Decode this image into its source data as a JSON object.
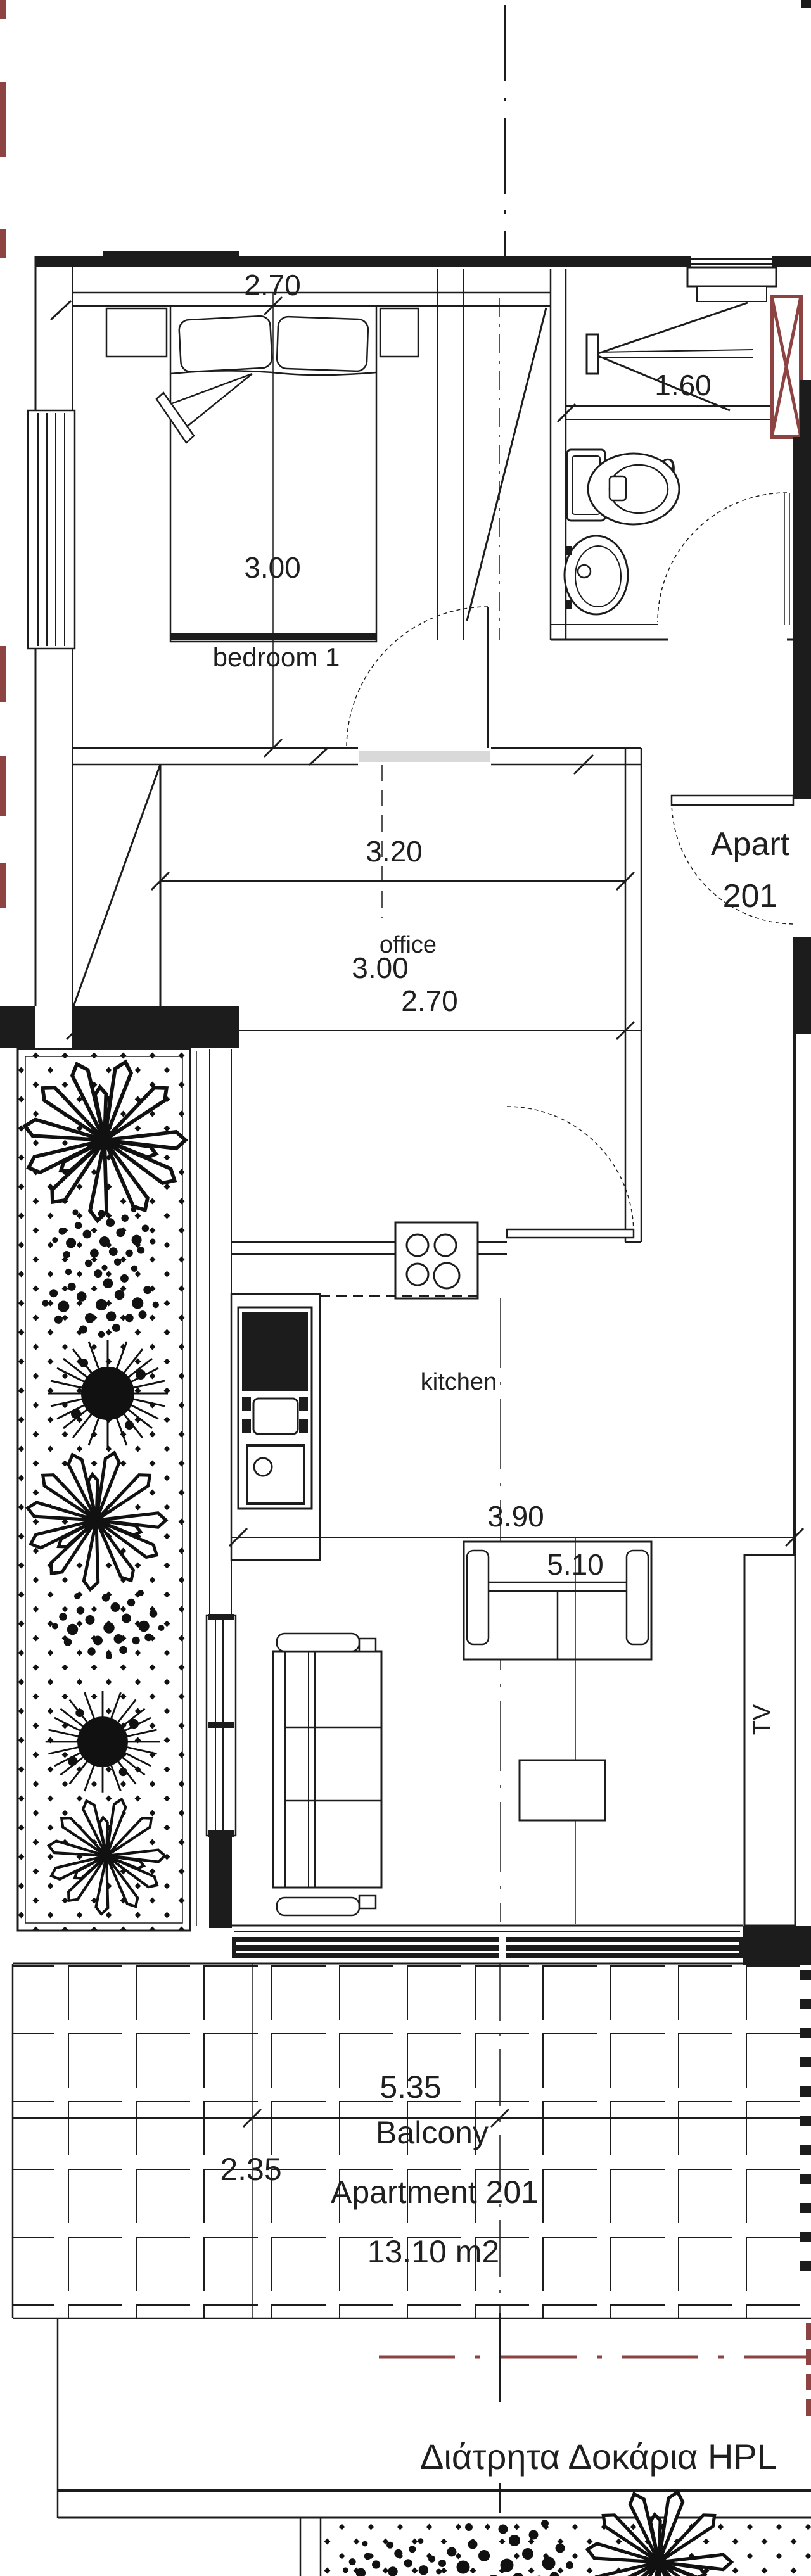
{
  "drawing": {
    "type": "floor-plan",
    "labels": {
      "bedroom": "bedroom 1",
      "office": "office",
      "kitchen": "kitchen",
      "tv": "TV",
      "apart_line1": "Apart",
      "apart_line2": "201",
      "balcony": "Balcony",
      "balcony_apartment": "Apartment 201",
      "balcony_area": "13.10 m2",
      "note_greek": "Διάτρητα Δοκάρια HPL"
    },
    "dimensions": {
      "bedroom_width": "2.70",
      "bedroom_length": "3.00",
      "shower_width": "1.60",
      "bathroom_width": "2.00",
      "office_width": "3.20",
      "office_depth_a": "3.00",
      "office_depth_b": "2.70",
      "kitchen_width": "3.90",
      "living_length": "5.10",
      "balcony_width": "5.35",
      "balcony_depth": "2.35"
    },
    "colors": {
      "line": "#1c1c1c",
      "accent_red": "#8e4343",
      "paper": "#ffffff"
    }
  }
}
